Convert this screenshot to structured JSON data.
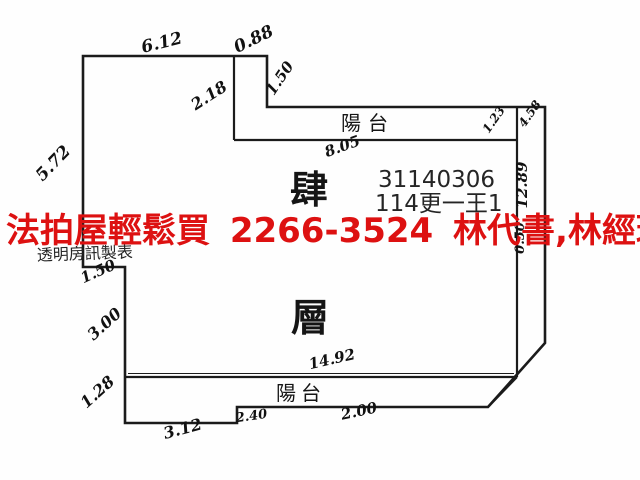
{
  "plan": {
    "floor": {
      "char1": "肆",
      "char2": "層"
    },
    "balcony_top_label": "陽台",
    "balcony_bottom_label": "陽台",
    "case_number": "31140306",
    "case_code": "114更一王1",
    "producer_note": "透明房訊製表",
    "dims": {
      "top_width": "6.12",
      "top_notch_width": "0.88",
      "top_notch_height": "1.50",
      "upper_inset": "2.18",
      "left_upper_wall": "5.72",
      "interior_width": "8.05",
      "balcony_right_end": "1.23",
      "right_strip_top": "4.58",
      "right_wall": "12.89",
      "right_wall_lower": "0.50",
      "left_step": "1.50",
      "left_mid_wall": "3.00",
      "left_lower_wall": "1.28",
      "bottom_left": "3.12",
      "bottom_step": "2.40",
      "bottom_right": "2.00",
      "interior_bottom_width": "14.92"
    }
  },
  "overlay": {
    "ad_text": "法拍屋輕鬆買 2266-3524 林代書,林經理",
    "ad_color": "#dd1111"
  },
  "colors": {
    "line": "#1b1b1b",
    "background": "#fefefe"
  }
}
